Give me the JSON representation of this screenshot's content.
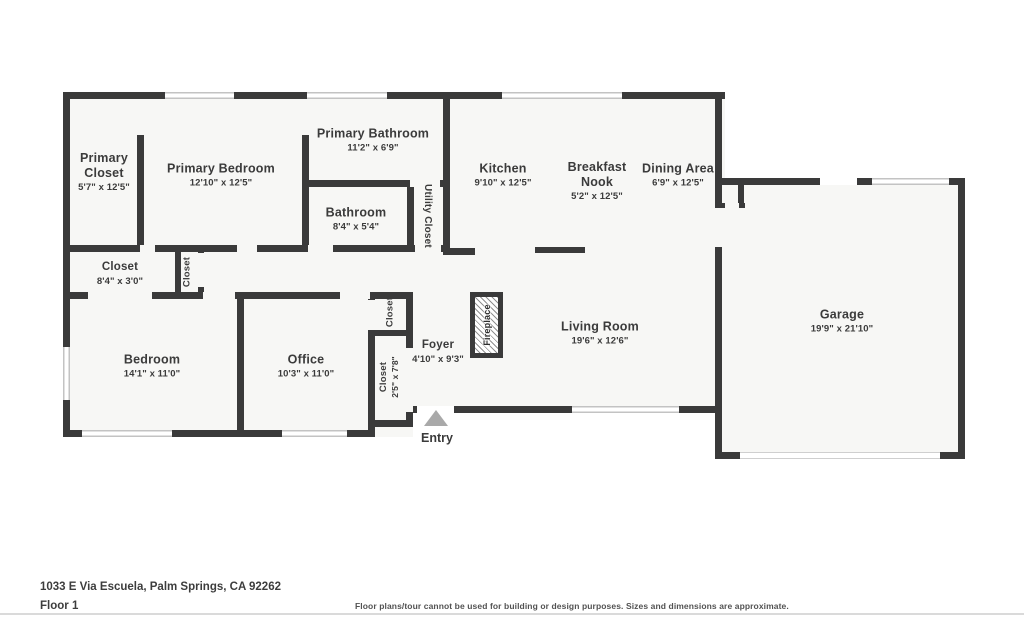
{
  "colors": {
    "wall": "#3a3a3a",
    "room_fill": "#f7f7f5",
    "window_line": "#c3c3c3",
    "entry_arrow": "#a9a9a9",
    "divider": "#dadada",
    "text": "#3b3b3b"
  },
  "rooms": {
    "primary_closet": {
      "name": "Primary Closet",
      "dims": "5'7\" x 12'5\""
    },
    "primary_bedroom": {
      "name": "Primary Bedroom",
      "dims": "12'10\" x 12'5\""
    },
    "primary_bathroom": {
      "name": "Primary Bathroom",
      "dims": "11'2\" x 6'9\""
    },
    "bathroom": {
      "name": "Bathroom",
      "dims": "8'4\" x 5'4\""
    },
    "utility_closet": {
      "name": "Utility Closet"
    },
    "kitchen": {
      "name": "Kitchen",
      "dims": "9'10\" x 12'5\""
    },
    "breakfast_nook": {
      "name": "Breakfast Nook",
      "dims": "5'2\" x 12'5\""
    },
    "dining_area": {
      "name": "Dining Area",
      "dims": "6'9\" x 12'5\""
    },
    "hall_closet": {
      "name": "Closet",
      "dims": "8'4\" x 3'0\""
    },
    "hall_closet_small": {
      "name": "Closet"
    },
    "bedroom": {
      "name": "Bedroom",
      "dims": "14'1\" x 11'0\""
    },
    "office": {
      "name": "Office",
      "dims": "10'3\" x 11'0\""
    },
    "office_closet_top": {
      "name": "Closet"
    },
    "office_closet_bottom": {
      "name": "Closet",
      "dims": "2'5\" x 7'8\""
    },
    "foyer": {
      "name": "Foyer",
      "dims": "4'10\" x 9'3\""
    },
    "fireplace": {
      "name": "Fireplace"
    },
    "living_room": {
      "name": "Living Room",
      "dims": "19'6\" x 12'6\""
    },
    "garage": {
      "name": "Garage",
      "dims": "19'9\" x 21'10\""
    },
    "entry": {
      "name": "Entry"
    }
  },
  "footer": {
    "address": "1033 E Via Escuela, Palm Springs, CA 92262",
    "floor_label": "Floor 1",
    "disclaimer": "Floor plans/tour cannot be used for building or design purposes. Sizes and dimensions are approximate."
  }
}
